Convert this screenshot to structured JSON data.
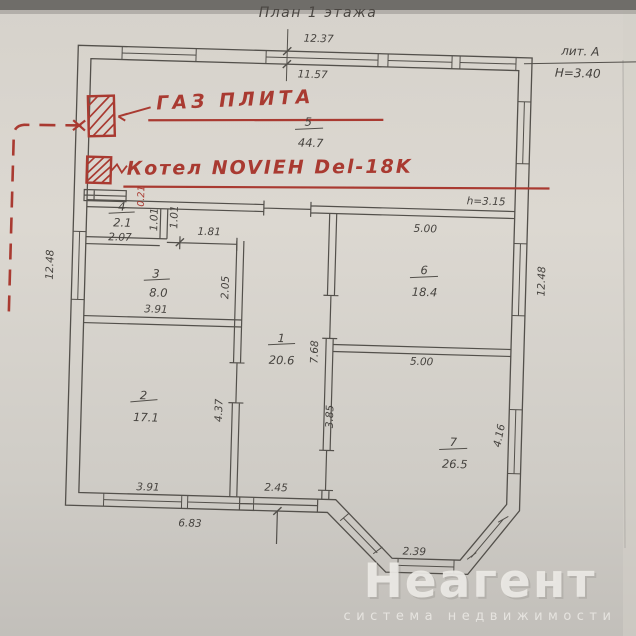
{
  "header": {
    "title": "План 1 этажа",
    "liter": "лит. А",
    "building_height": "H=3.40",
    "ceiling_height": "h=3.15"
  },
  "red_annotations": {
    "gas_stove": "ГАЗ ПЛИТА",
    "boiler": "Котел NOVIEH Del-18K",
    "pipe_dim": "0.21"
  },
  "rooms": [
    {
      "num": "1",
      "area": "20.6"
    },
    {
      "num": "2",
      "area": "17.1"
    },
    {
      "num": "3",
      "area": "8.0"
    },
    {
      "num": "4",
      "area": "2.1"
    },
    {
      "num": "5",
      "area": "44.7"
    },
    {
      "num": "6",
      "area": "18.4"
    },
    {
      "num": "7",
      "area": "26.5"
    }
  ],
  "dimensions": {
    "top_outer": "12.37",
    "top_inner": "11.57",
    "left_side": "12.48",
    "right_side": "12.48",
    "room4_width": "2.07",
    "niche_a": "1.01",
    "niche_b": "1.01",
    "hall_opening": "1.81",
    "room3_width": "3.91",
    "room3_depth": "2.05",
    "room2_width": "3.91",
    "room2_depth": "4.37",
    "hall_length": "7.68",
    "hall_lower": "3.85",
    "room6_width": "5.00",
    "room7_width": "5.00",
    "room7_side": "4.16",
    "bay_front": "2.39",
    "bottom_left": "6.83",
    "back_door": "2.45"
  },
  "watermark": {
    "brand": "Неагент",
    "tagline": "система недвижимости"
  },
  "colors": {
    "paper": "#d8d4cd",
    "ink": "#45423e",
    "red": "#a93a31",
    "watermark": "#eceae6"
  }
}
